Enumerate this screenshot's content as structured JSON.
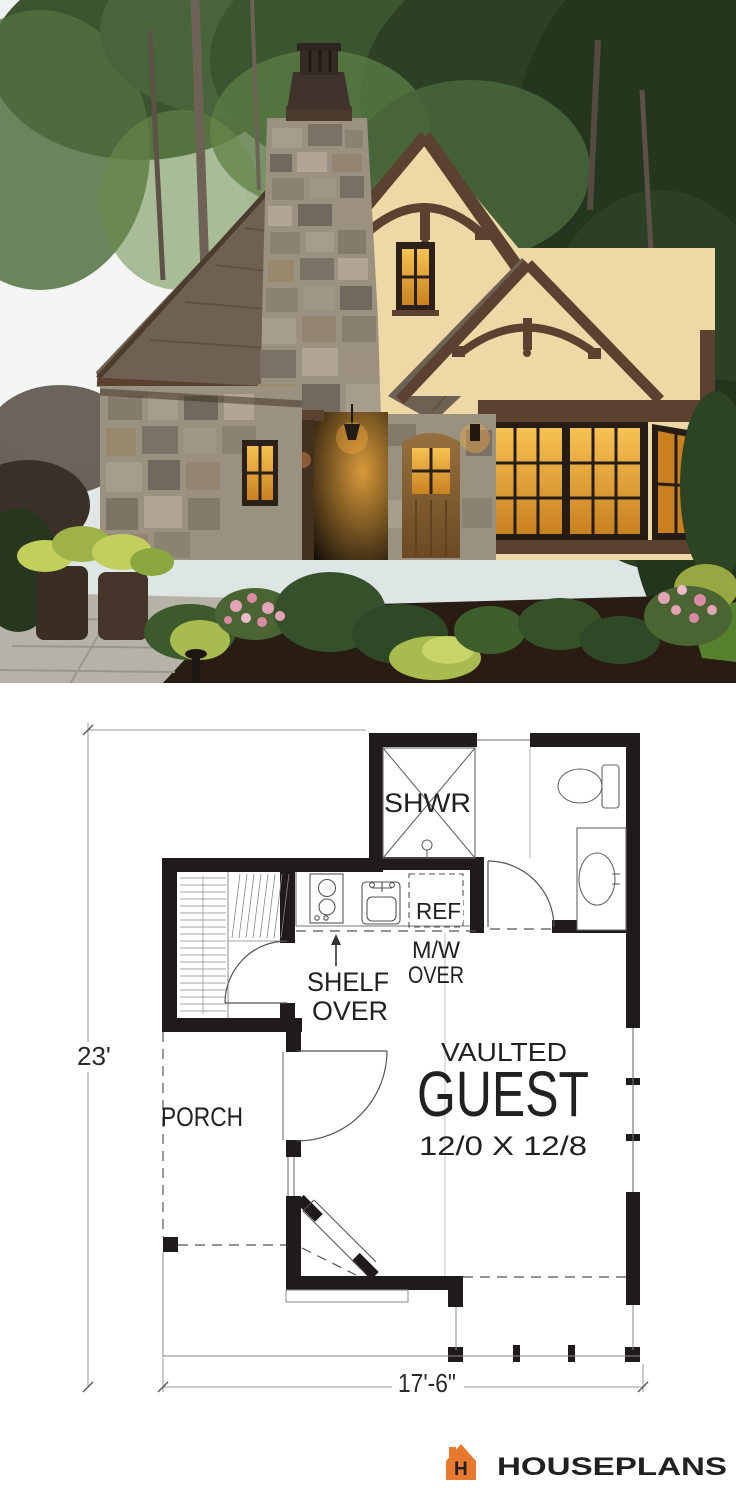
{
  "plan": {
    "wall_color": "#1e1b1a",
    "line_color": "#6e6e6e",
    "light_line_color": "#a9a9a9",
    "labels": {
      "shower": "SHWR",
      "fridge": "REF",
      "microwave_line1": "M/W",
      "microwave_line2": "OVER",
      "shelf_line1": "SHELF",
      "shelf_line2": "OVER",
      "porch": "PORCH",
      "room_type_line1": "VAULTED",
      "room_name": "GUEST",
      "room_size": "12/0 X 12/8"
    },
    "dimensions": {
      "side": "23'",
      "front": "17'-6\""
    }
  },
  "branding": {
    "name": "HOUSEPLANS",
    "icon": "house-logo-icon",
    "icon_letter": "H",
    "orange": "#e8792e",
    "text_color": "#343a40"
  },
  "photo": {
    "subject": "tudor-stone-stucco-tiny-cottage-at-dusk",
    "palette": {
      "sky": "#e6ecec",
      "sky_bright": "#f6f7f4",
      "foliage_dark": "#2c4023",
      "foliage_mid": "#47643a",
      "foliage_light": "#6c8c4c",
      "trunk": "#6e6156",
      "roof": "#6f6054",
      "roof_dark": "#55483e",
      "trim_brown": "#5a4130",
      "stucco": "#eed9a6",
      "stucco_shade": "#e0c28c",
      "stone": "#9a9181",
      "stone_dark": "#6f675c",
      "window_glow": "#f2a93b",
      "window_glow_deep": "#c9811f",
      "door_wood": "#8a6134",
      "dark_wood": "#43301e",
      "lawn": "#4f7c2d",
      "mulch": "#291c12",
      "path": "#b7b2a8",
      "flower_pink": "#e3a4b5",
      "flower_yellow_green": "#b5c255"
    }
  }
}
